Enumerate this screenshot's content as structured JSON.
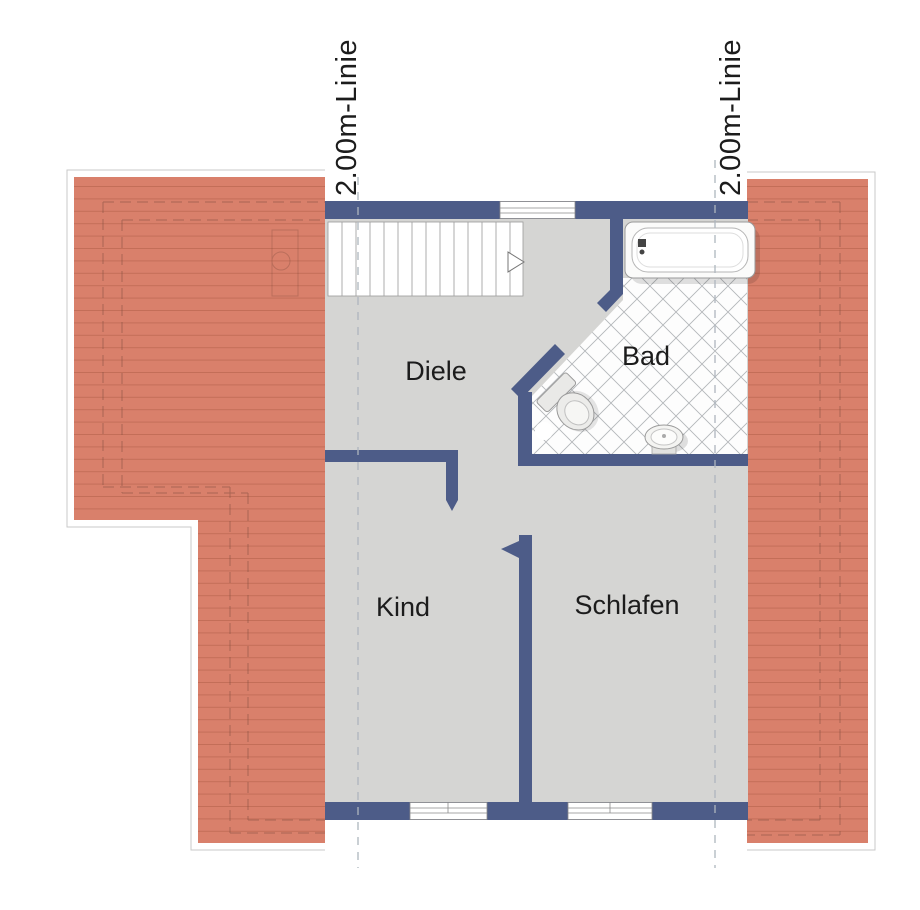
{
  "plan": {
    "title": "Dachgeschoss Grundriss",
    "rooms": [
      {
        "label": "Diele"
      },
      {
        "label": "Bad"
      },
      {
        "label": "Kind"
      },
      {
        "label": "Schlafen"
      }
    ],
    "guide_lines": {
      "left_label": "2.00m-Linie",
      "right_label": "2.00m-Linie"
    },
    "fixtures": [
      "bathtub-icon",
      "toilet-icon",
      "sink-icon",
      "stairs",
      "stair-direction-arrow-icon",
      "chimney-icon"
    ],
    "colors": {
      "wall": "#4d5c88",
      "roof": "#d9806b",
      "roof_line": "#b15e49",
      "roof_outline": "#c9c9c9",
      "floor": "#d5d5d3",
      "tile_bg": "#fdfdfd",
      "tile_line": "#b4b7ba",
      "hidden_edge": "#7a4a3c",
      "dashed_guide": "#aeb6be",
      "stair_line": "#999999",
      "fixture_stroke": "#9a9a9a",
      "label_text": "#1c1c1c"
    }
  }
}
